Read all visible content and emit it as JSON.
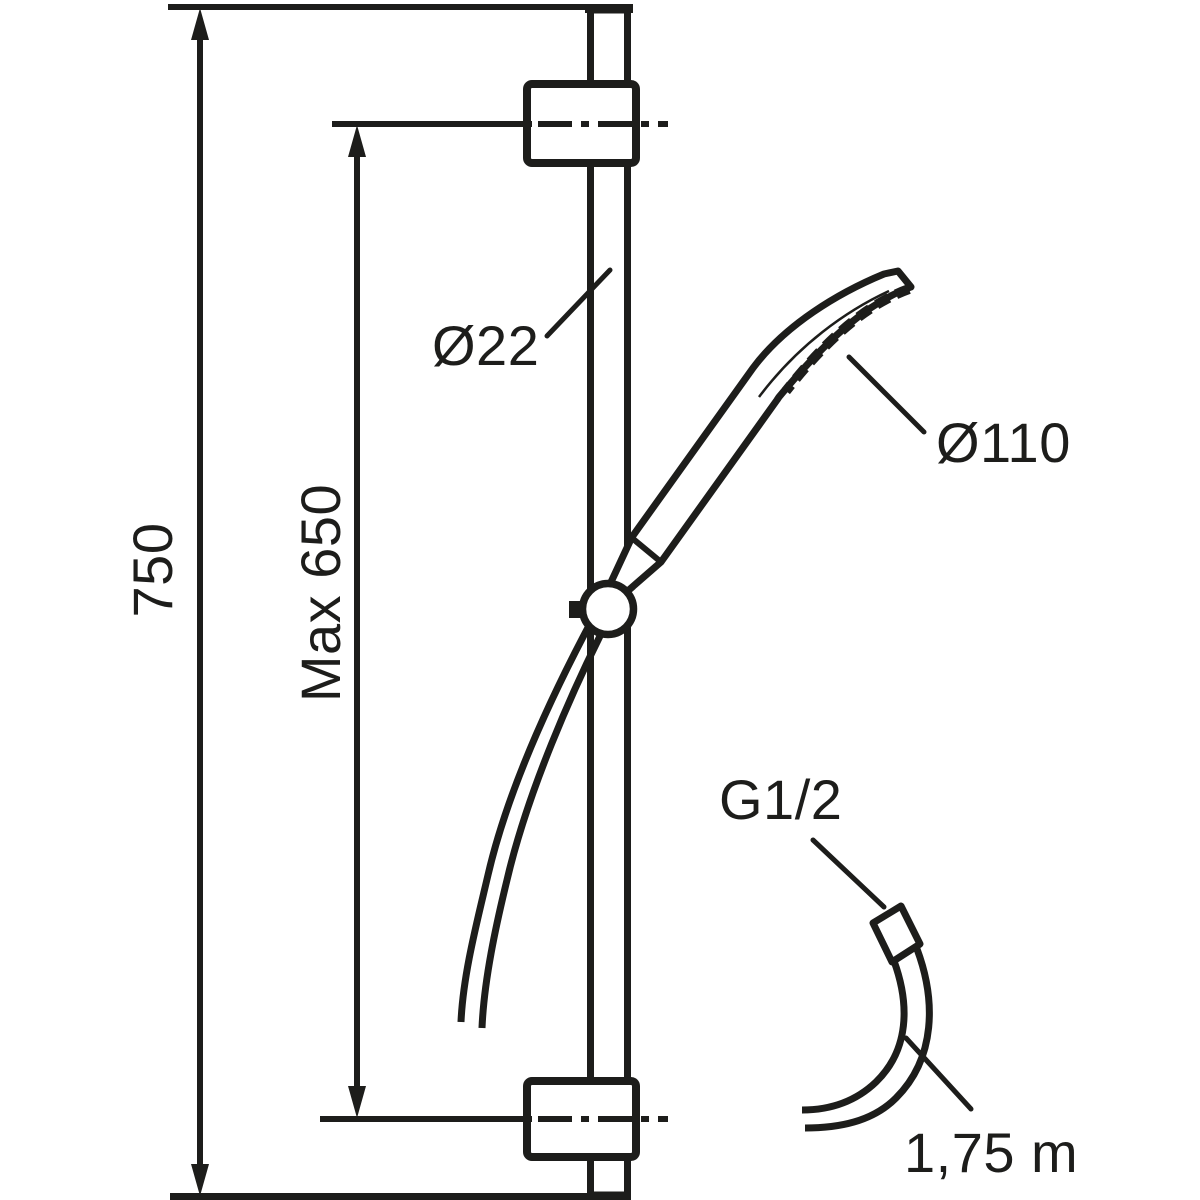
{
  "diagram": {
    "kind": "technical dimension drawing",
    "subject": "shower slide rail set with hand shower and hose"
  },
  "colors": {
    "line": "#1d1d1b",
    "background": "#ffffff"
  },
  "labels": {
    "overall_height": "750",
    "max_mounting_distance": "Max 650",
    "rail_diameter": "Ø22",
    "head_diameter": "Ø110",
    "thread_size": "G1/2",
    "hose_length": "1,75 m"
  }
}
